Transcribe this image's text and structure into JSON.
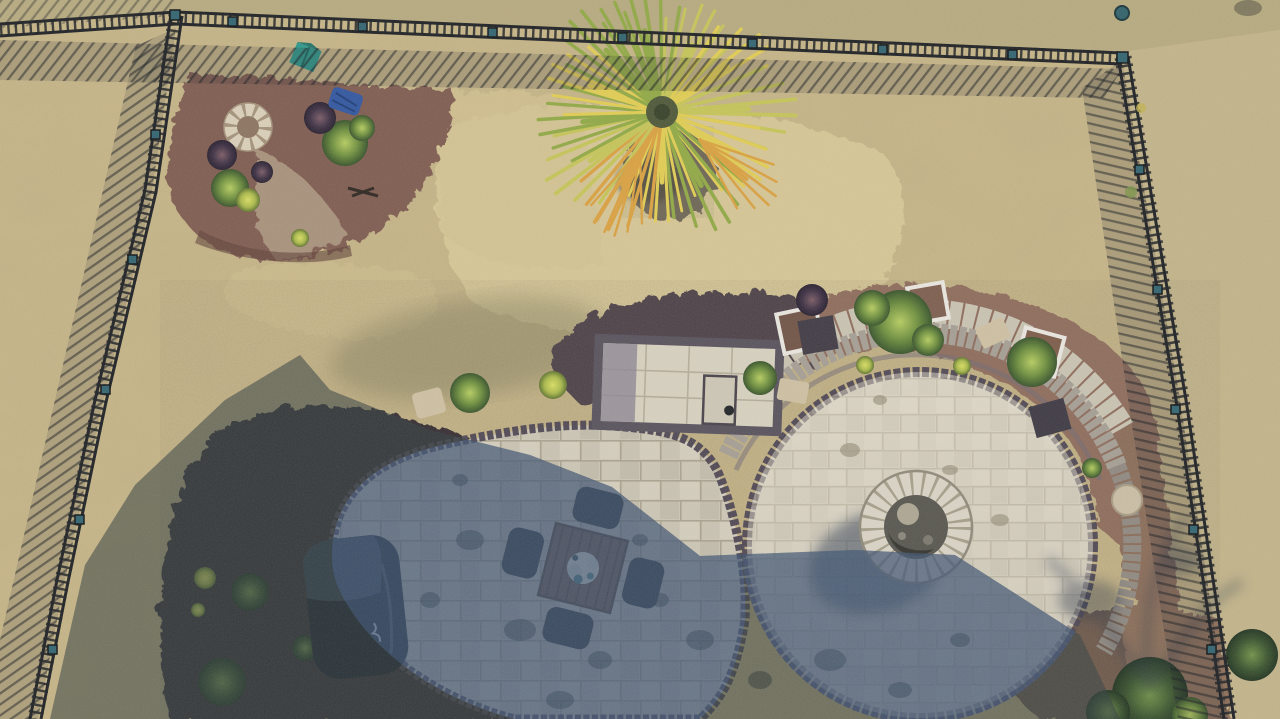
{
  "meta": {
    "title": "Aerial drone photograph of a fenced backyard with curved paver patio, fire pit, dining set, grill, palm tree and landscaped mulch beds",
    "type": "photograph",
    "view": "top-down aerial"
  },
  "scene": {
    "elements": [
      {
        "name": "lawn",
        "label": "Dry tan lawn"
      },
      {
        "name": "metal-fence",
        "label": "Black aluminum picket fence with post caps"
      },
      {
        "name": "mulch-island",
        "label": "Corner mulch planting island with stone ring"
      },
      {
        "name": "palm-tree",
        "label": "Palm tree seen from above"
      },
      {
        "name": "paver-patio",
        "label": "Two-lobe paver patio with dark border course"
      },
      {
        "name": "seat-wall",
        "label": "Curved stone seating wall with walkway"
      },
      {
        "name": "fire-pit",
        "label": "Circular stone fire pit"
      },
      {
        "name": "dining-set",
        "label": "Square wood table with four chairs"
      },
      {
        "name": "grill",
        "label": "Covered barbecue grill"
      },
      {
        "name": "planters",
        "label": "White framed square planters and shrubs"
      },
      {
        "name": "house-shadow",
        "label": "Long building shadow across lower left"
      }
    ]
  },
  "colors": {
    "grass_sunlit": "#c6b487",
    "grass_pale": "#d8c899",
    "grass_neighbor_top": "#b4a77e",
    "grass_neighbor_right": "#c1b38a",
    "shadow_cast": "#26344c",
    "shadow_grass_tint": "#3e4a33",
    "patio_blue_tint": "#4a66a0",
    "paver_border": "#4e4754",
    "wall_stone": "#a39d94",
    "walk_stone": "#c8c2b2",
    "mulch_island": "#7d5a4f",
    "mulch_dark": "#2f282f",
    "mulch_upper": "#463a44",
    "mulch_warm": "#8e6a5b",
    "mulch_pebble": "#8a6c59",
    "stone_ring": "#d9cfba",
    "firepit_ring": "#d8d3c6",
    "firepit_inner": "#55544e",
    "fence_metal": "#1b1e23",
    "post_cap": "#2f6270",
    "palm_green": "#8fa844",
    "palm_light": "#c4c458",
    "palm_yellow": "#e0cc52",
    "palm_orange": "#d9a040",
    "table_wood": "#6e5240",
    "chair_dark": "#23272e",
    "grill_cover": "#151c28",
    "grill_lid": "#31404f",
    "teal_box": "#2b968a",
    "tarp_blue": "#2f55a0",
    "slab_tan": "#cdbfa2",
    "planter_white": "#e8e6e0",
    "boulder": "#c9bda4"
  }
}
